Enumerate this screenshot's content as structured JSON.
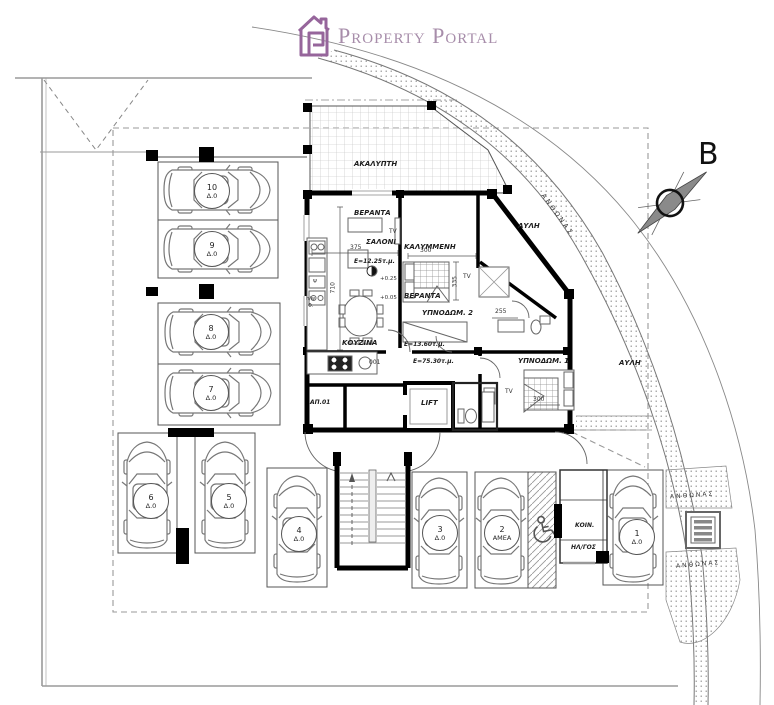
{
  "logo": {
    "title": "Property Portal",
    "icon": "house",
    "icon_color": "#96659b",
    "text_color": "#a78daa"
  },
  "compass": {
    "label": "B"
  },
  "site": {
    "band_label": "ΑΝΘΩΝΑΣ",
    "planter_top_label": "ΑΝΘΩΝΑΣ",
    "planter_bottom_label": "ΑΝΘΩΝΑΣ",
    "yard_top": "ΑΥΛΗ",
    "yard_right": "ΑΥΛΗ"
  },
  "unit": {
    "uncovered_veranda": {
      "name_line1": "ΑΚΑΛΥΠΤΗ",
      "name_line2": "ΒΕΡΑΝΤΑ",
      "area": "Ε=12.25τ.μ."
    },
    "covered_veranda": {
      "name_line1": "ΚΑΛΥΜΜΕΝΗ",
      "name_line2": "ΒΕΡΑΝΤΑ",
      "area": "Ε=13.60τ.μ."
    },
    "living_room": "ΣΑΛΟΝΙ",
    "kitchen": "ΚΟΥΖΙΝΑ",
    "bedroom2": "ΥΠΝΟΔΩΜ. 2",
    "bedroom1": "ΥΠΝΟΔΩΜ. 1",
    "lift": "LIFT",
    "entry_door_code": "001",
    "apartment_code": "ΑΠ.01",
    "total_area": "Ε=75.30τ.μ.",
    "tv": "TV",
    "levels": {
      "upper": "+0.25",
      "lower": "+0.05"
    },
    "appliances": {
      "fridge": "Ψ",
      "heater": "h/w",
      "oven": "Φ."
    },
    "dims": {
      "salon_w": "375",
      "salon_h": "710",
      "bed2_w": "300",
      "bed2_h": "335",
      "bath_w": "255",
      "bed1_w": "300"
    }
  },
  "services": {
    "electrical_line1": "ΚΟΙΝ.",
    "electrical_line2": "ΗΛ/ΓΟΣ"
  },
  "parking": {
    "spaces": [
      {
        "number": "10",
        "tag": "Δ.0"
      },
      {
        "number": "9",
        "tag": "Δ.0"
      },
      {
        "number": "8",
        "tag": "Δ.0"
      },
      {
        "number": "7",
        "tag": "Δ.0"
      },
      {
        "number": "6",
        "tag": "Δ.0"
      },
      {
        "number": "5",
        "tag": "Δ.0"
      },
      {
        "number": "4",
        "tag": "Δ.0"
      },
      {
        "number": "3",
        "tag": "Δ.0"
      },
      {
        "number": "2",
        "tag": "ΑΜΕΑ"
      },
      {
        "number": "1",
        "tag": "Δ.0"
      }
    ]
  }
}
